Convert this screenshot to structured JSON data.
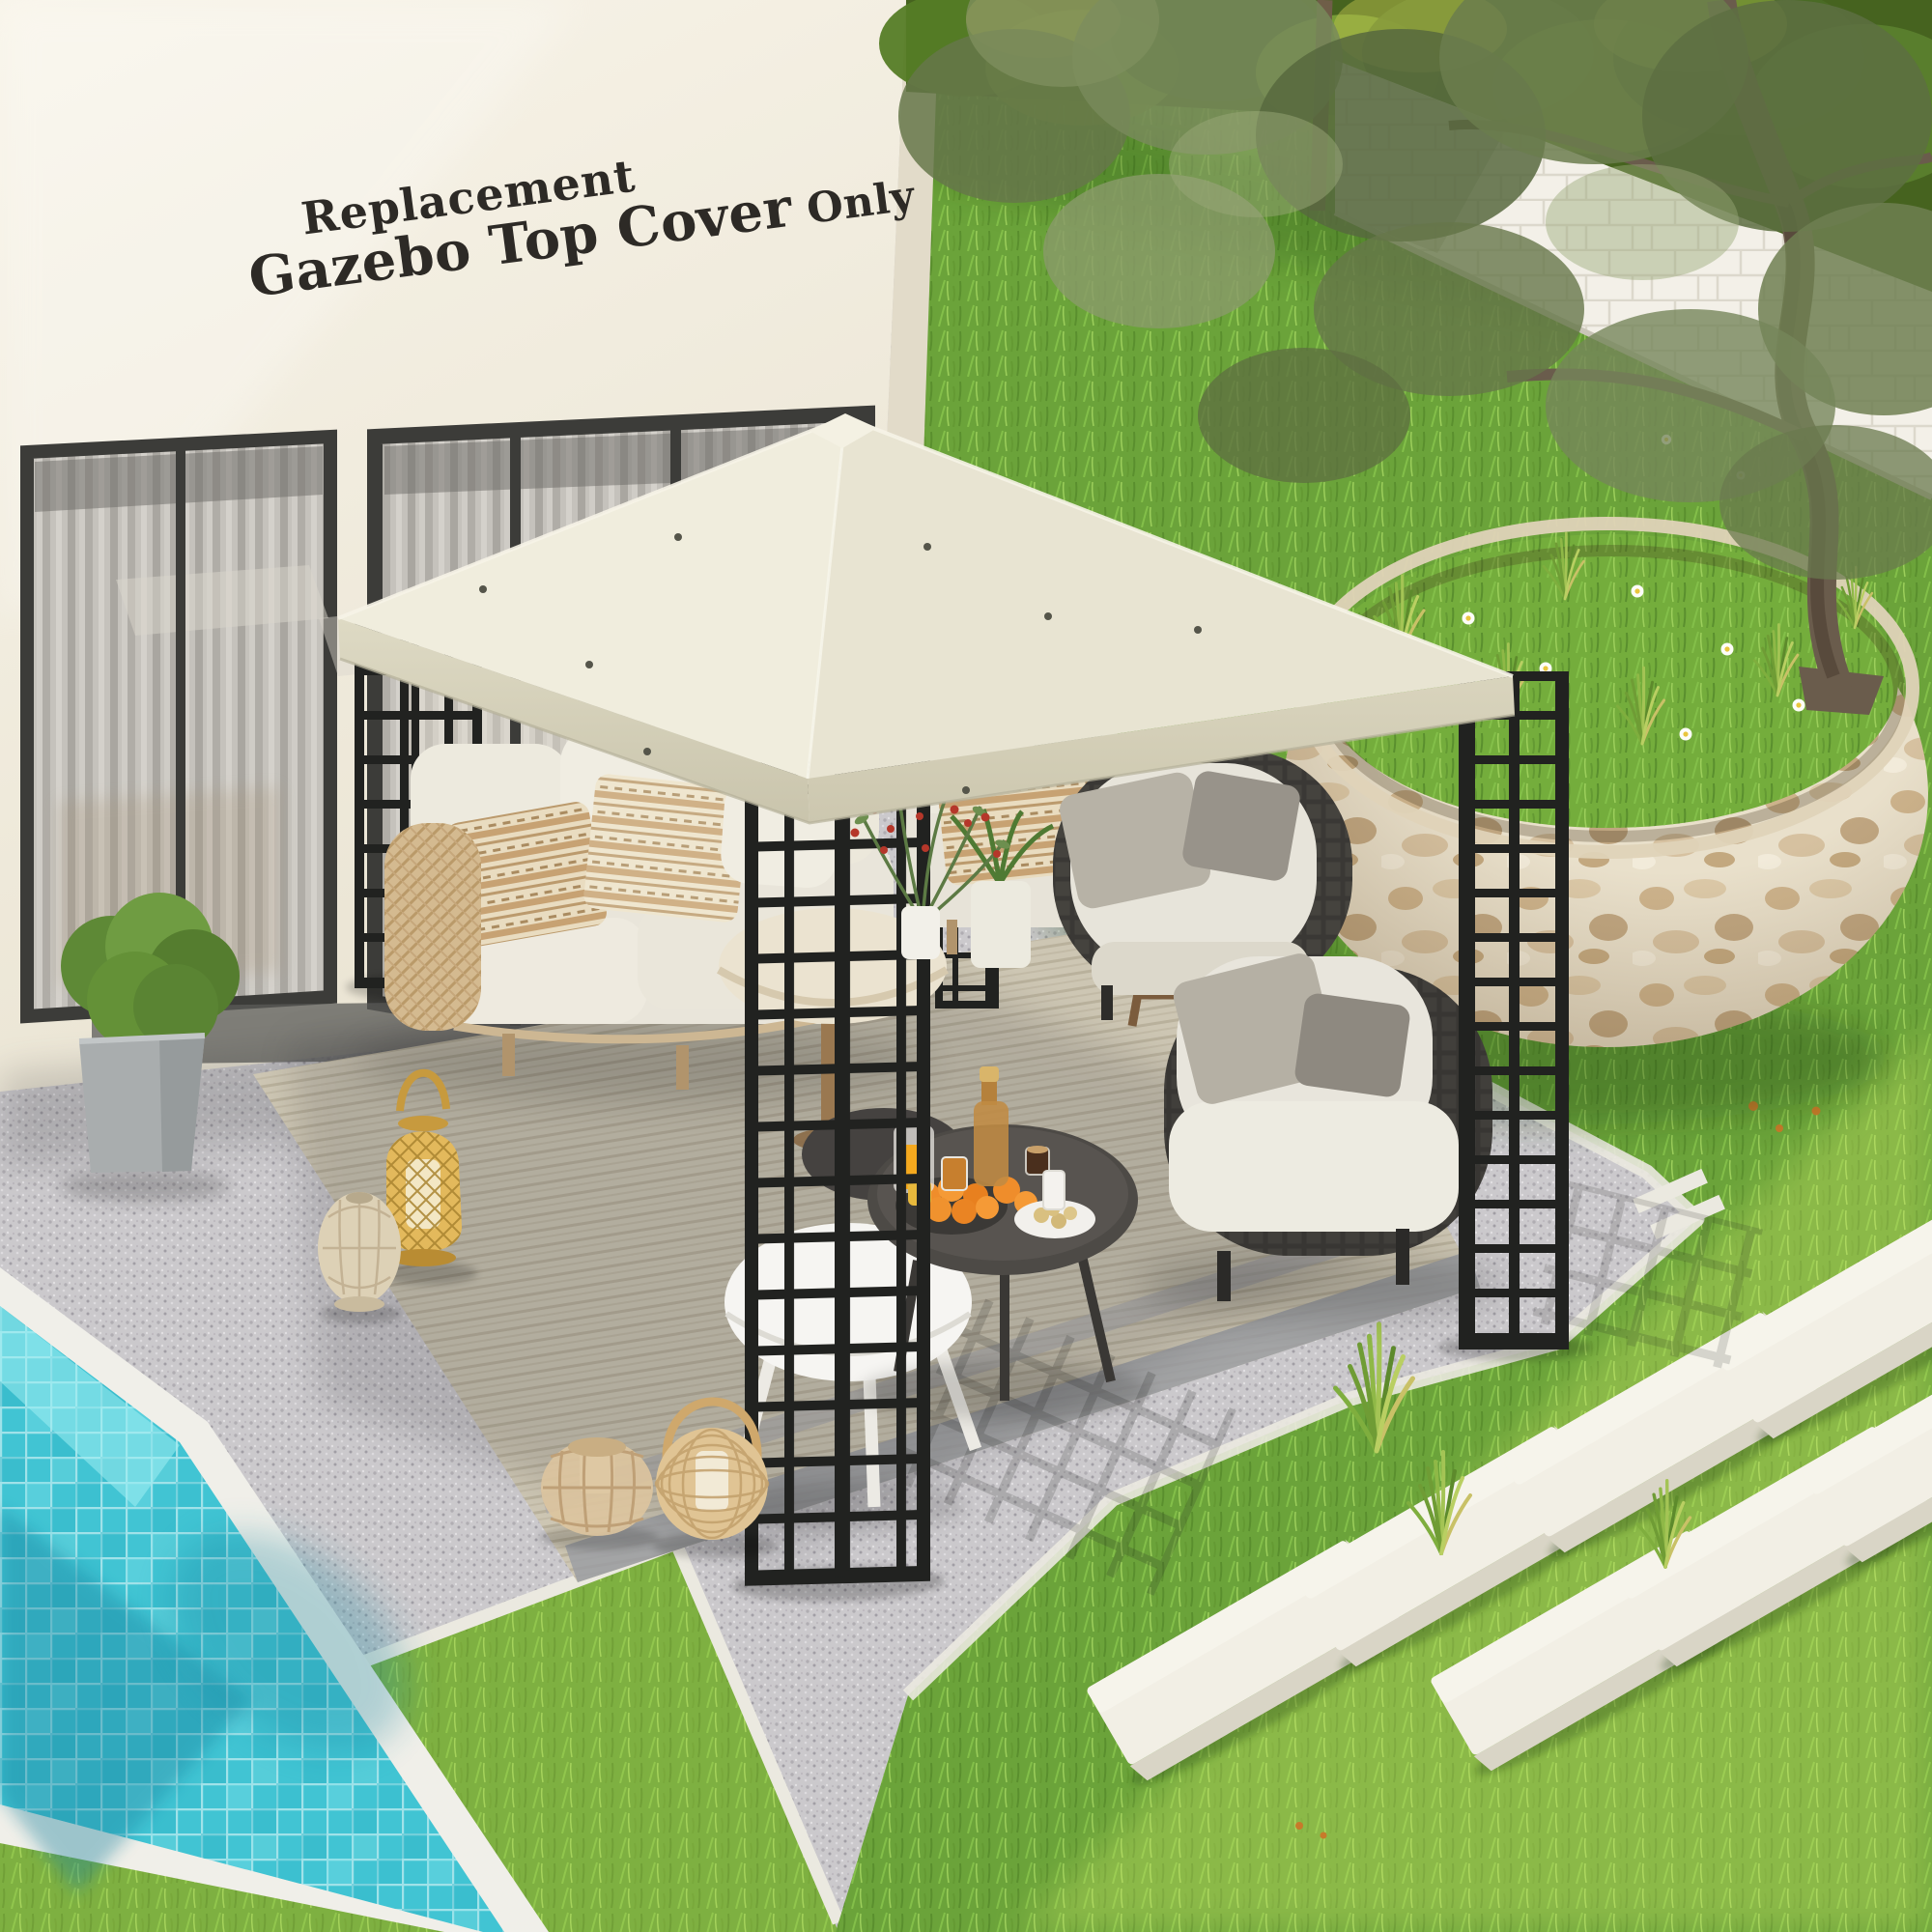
{
  "image_type": "product lifestyle photo",
  "headline": {
    "line1": "Replacement",
    "line2": "Gazebo Top Cover",
    "line2_suffix": " Only"
  },
  "palette": {
    "canopy_cream": "#eeeadb",
    "frame_black": "#222220",
    "wall_cream": "#f2ede0",
    "gravel_gray": "#cac8cb",
    "grass_green": "#6ba33a",
    "grass_bright": "#9ccf4f",
    "pool_turquoise": "#41c4d3",
    "coping_white": "#f0efe9",
    "stone_planter_beige": "#e8dfca",
    "rug_beige": "#cdc6b3",
    "rattan_gold": "#d9b35e",
    "orange_fruit": "#ef8d2b",
    "text_dark": "#2d2a26"
  },
  "scene_objects": [
    "cream gazebo top canopy on black lattice posts",
    "house wall with curtained window",
    "outdoor cream sofa with boho pillows",
    "two dark woven lounge chairs",
    "round coffee tables with oranges and drinks",
    "rattan lanterns",
    "boxwood in gray planter",
    "turquoise tiled swimming pool",
    "gravel patio with woven rug",
    "lawn with white stepping stones",
    "round stone raised planter with olive tree",
    "white brick garden wall with trees"
  ]
}
